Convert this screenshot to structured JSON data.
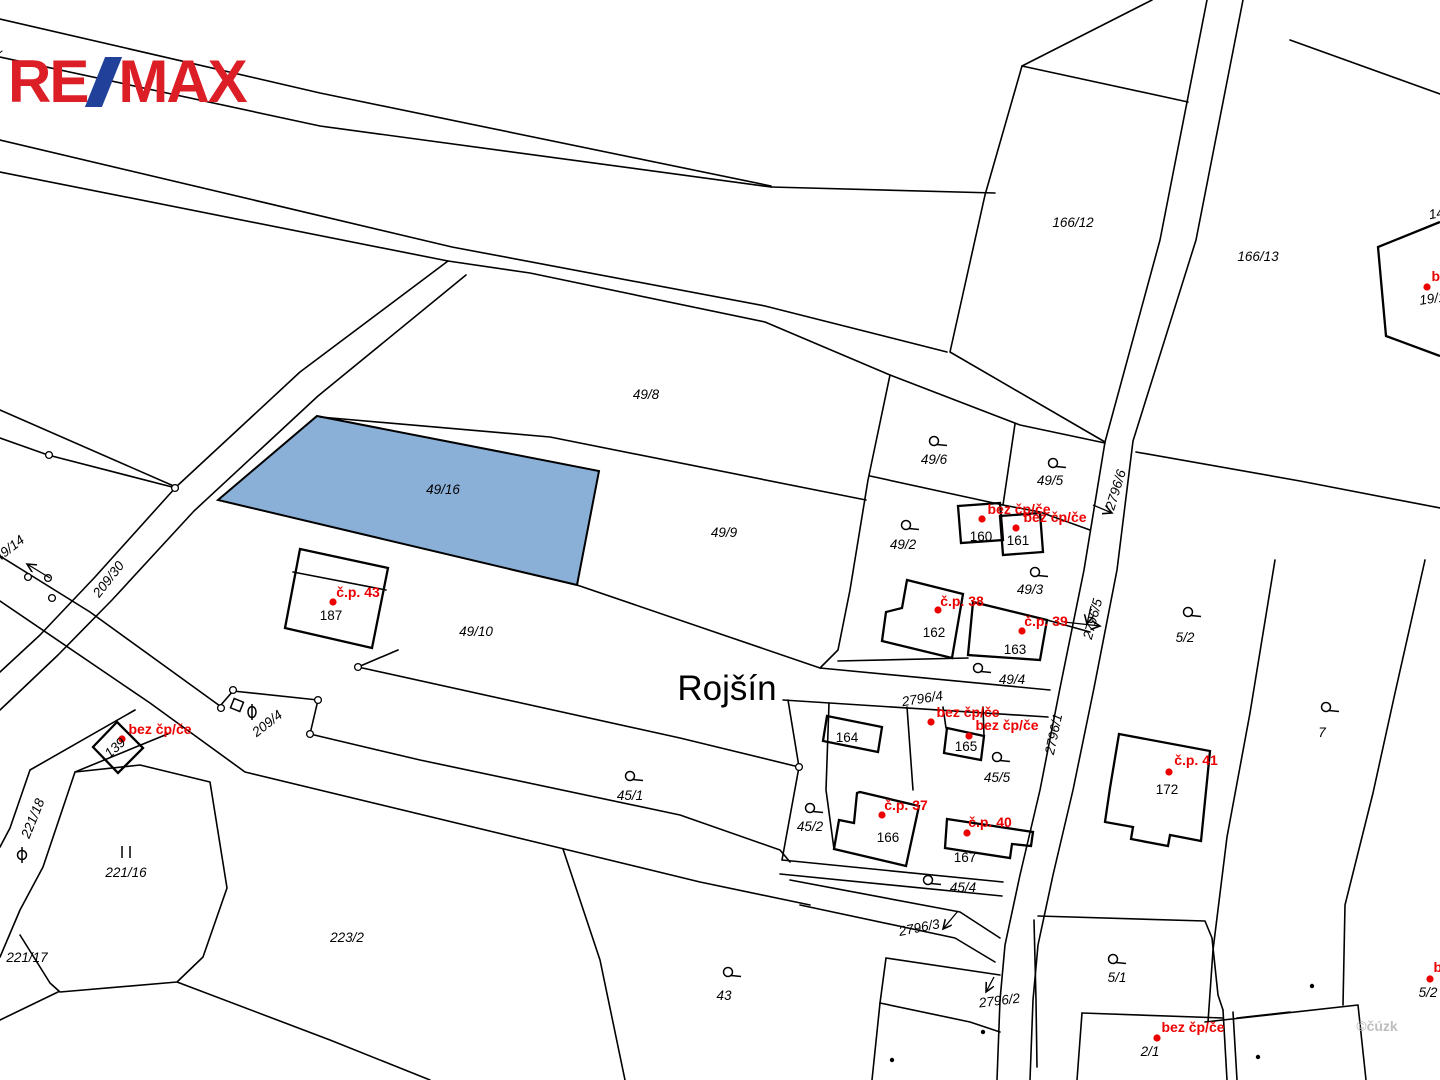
{
  "branding": {
    "logo_re": "RE",
    "logo_max": "MAX",
    "logo_red": "#dc1f26",
    "logo_blue": "#20409a"
  },
  "map": {
    "place_label": "Rojšín",
    "watermark": "©čúzk",
    "highlight_parcel": "49/16",
    "highlight_color": "#8bb0d8",
    "red_color": "#ec0000",
    "labels": [
      {
        "t": "52",
        "x": -2,
        "y": 55,
        "r": -40,
        "c": "lp"
      },
      {
        "t": "166/12",
        "x": 1073,
        "y": 227,
        "r": 0,
        "c": "lp"
      },
      {
        "t": "166/13",
        "x": 1258,
        "y": 261,
        "r": 0,
        "c": "lp"
      },
      {
        "t": "14",
        "x": 1437,
        "y": 218,
        "r": -10,
        "c": "lp"
      },
      {
        "t": "19/1",
        "x": 1433,
        "y": 303,
        "r": -8,
        "c": "lp"
      },
      {
        "t": "49/8",
        "x": 646,
        "y": 399,
        "r": 0,
        "c": "lp"
      },
      {
        "t": "49/6",
        "x": 934,
        "y": 464,
        "r": 0,
        "c": "lp"
      },
      {
        "t": "49/5",
        "x": 1050,
        "y": 485,
        "r": 0,
        "c": "lp"
      },
      {
        "t": "2796/6",
        "x": 1120,
        "y": 491,
        "r": -73,
        "c": "lp"
      },
      {
        "t": "49/16",
        "x": 443,
        "y": 494,
        "r": 0,
        "c": "lp"
      },
      {
        "t": "49/9",
        "x": 724,
        "y": 537,
        "r": 0,
        "c": "lp"
      },
      {
        "t": "49/2",
        "x": 903,
        "y": 549,
        "r": 0,
        "c": "lp"
      },
      {
        "t": "160",
        "x": 981,
        "y": 541,
        "r": 0,
        "c": "lb"
      },
      {
        "t": "161",
        "x": 1018,
        "y": 545,
        "r": 0,
        "c": "lb"
      },
      {
        "t": "49/3",
        "x": 1030,
        "y": 594,
        "r": 0,
        "c": "lp"
      },
      {
        "t": "2796/5",
        "x": 1097,
        "y": 620,
        "r": -75,
        "c": "lp"
      },
      {
        "t": "162",
        "x": 934,
        "y": 637,
        "r": 0,
        "c": "lb"
      },
      {
        "t": "163",
        "x": 1015,
        "y": 654,
        "r": 0,
        "c": "lb"
      },
      {
        "t": "5/2",
        "x": 1185,
        "y": 642,
        "r": 0,
        "c": "lp"
      },
      {
        "t": "187",
        "x": 331,
        "y": 620,
        "r": 0,
        "c": "lb"
      },
      {
        "t": "49/10",
        "x": 476,
        "y": 636,
        "r": 0,
        "c": "lp"
      },
      {
        "t": "209/30",
        "x": 112,
        "y": 582,
        "r": -52,
        "c": "lp"
      },
      {
        "t": "49/14",
        "x": 12,
        "y": 552,
        "r": -38,
        "c": "lp"
      },
      {
        "t": "Rojšín",
        "x": 727,
        "y": 700,
        "r": 0,
        "c": "lbig"
      },
      {
        "t": "2796/4",
        "x": 923,
        "y": 703,
        "r": -9,
        "c": "lp"
      },
      {
        "t": "49/4",
        "x": 1012,
        "y": 684,
        "r": 0,
        "c": "lp"
      },
      {
        "t": "2796/1",
        "x": 1058,
        "y": 735,
        "r": -78,
        "c": "lp"
      },
      {
        "t": "164",
        "x": 847,
        "y": 742,
        "r": 0,
        "c": "lb"
      },
      {
        "t": "165",
        "x": 966,
        "y": 751,
        "r": 0,
        "c": "lb"
      },
      {
        "t": "45/5",
        "x": 997,
        "y": 782,
        "r": 0,
        "c": "lp"
      },
      {
        "t": "172",
        "x": 1167,
        "y": 794,
        "r": 0,
        "c": "lb"
      },
      {
        "t": "7",
        "x": 1322,
        "y": 737,
        "r": 0,
        "c": "lp"
      },
      {
        "t": "45/2",
        "x": 810,
        "y": 831,
        "r": 0,
        "c": "lp"
      },
      {
        "t": "166",
        "x": 888,
        "y": 842,
        "r": 0,
        "c": "lb"
      },
      {
        "t": "167",
        "x": 965,
        "y": 862,
        "r": 0,
        "c": "lb"
      },
      {
        "t": "45/1",
        "x": 630,
        "y": 800,
        "r": 0,
        "c": "lp"
      },
      {
        "t": "209/4",
        "x": 270,
        "y": 727,
        "r": -38,
        "c": "lp"
      },
      {
        "t": "139",
        "x": 118,
        "y": 751,
        "r": -42,
        "c": "lp"
      },
      {
        "t": "221/18",
        "x": 37,
        "y": 820,
        "r": -68,
        "c": "lp"
      },
      {
        "t": "221/16",
        "x": 126,
        "y": 877,
        "r": 0,
        "c": "lp"
      },
      {
        "t": "221/17",
        "x": 27,
        "y": 962,
        "r": 0,
        "c": "lp"
      },
      {
        "t": "223/2",
        "x": 347,
        "y": 942,
        "r": 0,
        "c": "lp"
      },
      {
        "t": "43",
        "x": 724,
        "y": 1000,
        "r": 0,
        "c": "lp"
      },
      {
        "t": "45/4",
        "x": 963,
        "y": 892,
        "r": 0,
        "c": "lp"
      },
      {
        "t": "2796/3",
        "x": 920,
        "y": 932,
        "r": -11,
        "c": "lp"
      },
      {
        "t": "2796/2",
        "x": 1000,
        "y": 1005,
        "r": -7,
        "c": "lp"
      },
      {
        "t": "5/1",
        "x": 1117,
        "y": 982,
        "r": 0,
        "c": "lp"
      },
      {
        "t": "2/1",
        "x": 1150,
        "y": 1056,
        "r": 0,
        "c": "lp"
      },
      {
        "t": "5/2",
        "x": 1428,
        "y": 997,
        "r": 0,
        "c": "lp"
      },
      {
        "t": "©čúzk",
        "x": 1377,
        "y": 1031,
        "r": 0,
        "c": "lwm"
      }
    ],
    "red_labels": [
      {
        "t": "č.p. 43",
        "x": 358,
        "y": 597,
        "dx": 333,
        "dy": 602
      },
      {
        "t": "bez čp/če",
        "x": 1019,
        "y": 514,
        "dx": 982,
        "dy": 519
      },
      {
        "t": "bez čp/če",
        "x": 1055,
        "y": 522,
        "dx": 1016,
        "dy": 528
      },
      {
        "t": "č.p. 38",
        "x": 962,
        "y": 606,
        "dx": 938,
        "dy": 610
      },
      {
        "t": "č.p. 39",
        "x": 1046,
        "y": 626,
        "dx": 1022,
        "dy": 631
      },
      {
        "t": "bez čp/če",
        "x": 968,
        "y": 717,
        "dx": 931,
        "dy": 722
      },
      {
        "t": "bez čp/če",
        "x": 1007,
        "y": 730,
        "dx": 969,
        "dy": 736
      },
      {
        "t": "č.p. 37",
        "x": 906,
        "y": 810,
        "dx": 882,
        "dy": 815
      },
      {
        "t": "č.p. 40",
        "x": 990,
        "y": 827,
        "dx": 967,
        "dy": 833
      },
      {
        "t": "č.p. 41",
        "x": 1196,
        "y": 765,
        "dx": 1169,
        "dy": 772
      },
      {
        "t": "bez čp/če",
        "x": 160,
        "y": 734,
        "dx": 122,
        "dy": 739
      },
      {
        "t": "bez čp/če",
        "x": 1193,
        "y": 1032,
        "dx": 1157,
        "dy": 1038
      },
      {
        "t": "bez čp/če",
        "x": 1465,
        "y": 972,
        "dx": 1430,
        "dy": 979
      },
      {
        "t": "bez čp/če",
        "x": 1463,
        "y": 281,
        "dx": 1427,
        "dy": 287
      }
    ],
    "symbols": {
      "garden": [
        {
          "x": 934,
          "y": 441
        },
        {
          "x": 1053,
          "y": 463
        },
        {
          "x": 906,
          "y": 525
        },
        {
          "x": 1035,
          "y": 572
        },
        {
          "x": 1188,
          "y": 612
        },
        {
          "x": 978,
          "y": 668
        },
        {
          "x": 997,
          "y": 757
        },
        {
          "x": 1326,
          "y": 707
        },
        {
          "x": 810,
          "y": 808
        },
        {
          "x": 630,
          "y": 776
        },
        {
          "x": 928,
          "y": 880
        },
        {
          "x": 728,
          "y": 972
        },
        {
          "x": 1113,
          "y": 959
        }
      ],
      "vertex": [
        {
          "x": 175,
          "y": 488
        },
        {
          "x": 49,
          "y": 455
        },
        {
          "x": 233,
          "y": 690
        },
        {
          "x": 221,
          "y": 708
        },
        {
          "x": 318,
          "y": 700
        },
        {
          "x": 310,
          "y": 734
        },
        {
          "x": 358,
          "y": 667
        },
        {
          "x": 799,
          "y": 767
        },
        {
          "x": 28,
          "y": 577
        },
        {
          "x": 48,
          "y": 578
        },
        {
          "x": 52,
          "y": 598
        }
      ],
      "dots": [
        {
          "x": 892,
          "y": 1060
        },
        {
          "x": 983,
          "y": 1032
        },
        {
          "x": 1312,
          "y": 986
        },
        {
          "x": 1258,
          "y": 1057
        }
      ],
      "square": {
        "x": 237,
        "y": 705,
        "r": 22
      },
      "theta": {
        "x": 252,
        "y": 712
      },
      "phi": {
        "x": 22,
        "y": 855
      },
      "pillars": {
        "x": 126,
        "y": 852
      }
    },
    "arrows": [
      {
        "x1": 50,
        "y1": 578,
        "x2": 27,
        "y2": 564
      },
      {
        "x1": 1093,
        "y1": 505,
        "x2": 1112,
        "y2": 513
      },
      {
        "x1": 1064,
        "y1": 622,
        "x2": 1100,
        "y2": 626
      },
      {
        "x1": 1091,
        "y1": 606,
        "x2": 1087,
        "y2": 624
      },
      {
        "x1": 958,
        "y1": 911,
        "x2": 943,
        "y2": 929
      },
      {
        "x1": 994,
        "y1": 977,
        "x2": 986,
        "y2": 992
      }
    ]
  }
}
